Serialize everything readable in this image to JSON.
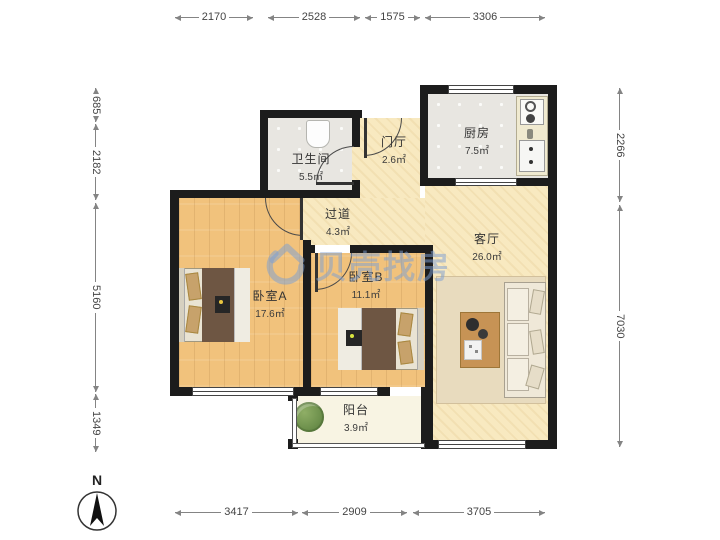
{
  "watermark": {
    "brand": "贝壳找房",
    "color": "#7da0d2"
  },
  "compass": {
    "label": "N"
  },
  "dimensions": {
    "top": [
      "2170",
      "2528",
      "1575",
      "3306"
    ],
    "bottom": [
      "3417",
      "2909",
      "3705"
    ],
    "left": [
      "685",
      "2182",
      "5160",
      "1349"
    ],
    "right": [
      "2266",
      "7030"
    ]
  },
  "rooms": [
    {
      "id": "bathroom",
      "name": "卫生间",
      "area": "5.5㎡"
    },
    {
      "id": "foyer",
      "name": "门厅",
      "area": "2.6㎡"
    },
    {
      "id": "kitchen",
      "name": "厨房",
      "area": "7.5㎡"
    },
    {
      "id": "hallway",
      "name": "过道",
      "area": "4.3㎡"
    },
    {
      "id": "living-room",
      "name": "客厅",
      "area": "26.0㎡"
    },
    {
      "id": "bedroom-a",
      "name": "卧室A",
      "area": "17.6㎡"
    },
    {
      "id": "bedroom-b",
      "name": "卧室B",
      "area": "11.1㎡"
    },
    {
      "id": "balcony",
      "name": "阳台",
      "area": "3.9㎡"
    }
  ],
  "colors": {
    "wall": "#1c1c1c",
    "wood_floor": "#f1c27c",
    "warm_floor": "#f8e9c0",
    "tile_floor": "#e8e6e1",
    "balcony_floor": "#f8f4e3"
  }
}
